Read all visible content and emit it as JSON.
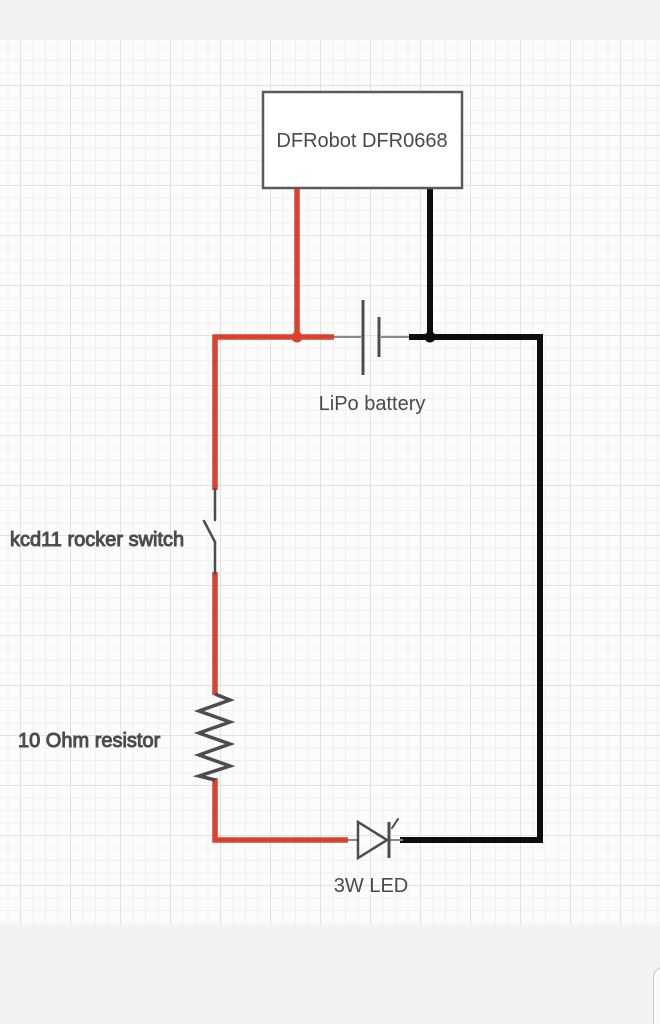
{
  "components": {
    "board": {
      "label": "DFRobot DFR0668"
    },
    "battery": {
      "label": "LiPo battery"
    },
    "rocker_switch": {
      "label": "kcd11 rocker switch"
    },
    "resistor": {
      "label": "10 Ohm resistor"
    },
    "led": {
      "label": "3W LED"
    }
  },
  "colors": {
    "positive_wire": "#d8432e",
    "negative_wire": "#0d0d0d",
    "component_stroke": "#4d4d4d",
    "connector_stroke": "#8a8a8a",
    "board_border": "#5a5a5a",
    "label_text": "#4a4a4a"
  }
}
